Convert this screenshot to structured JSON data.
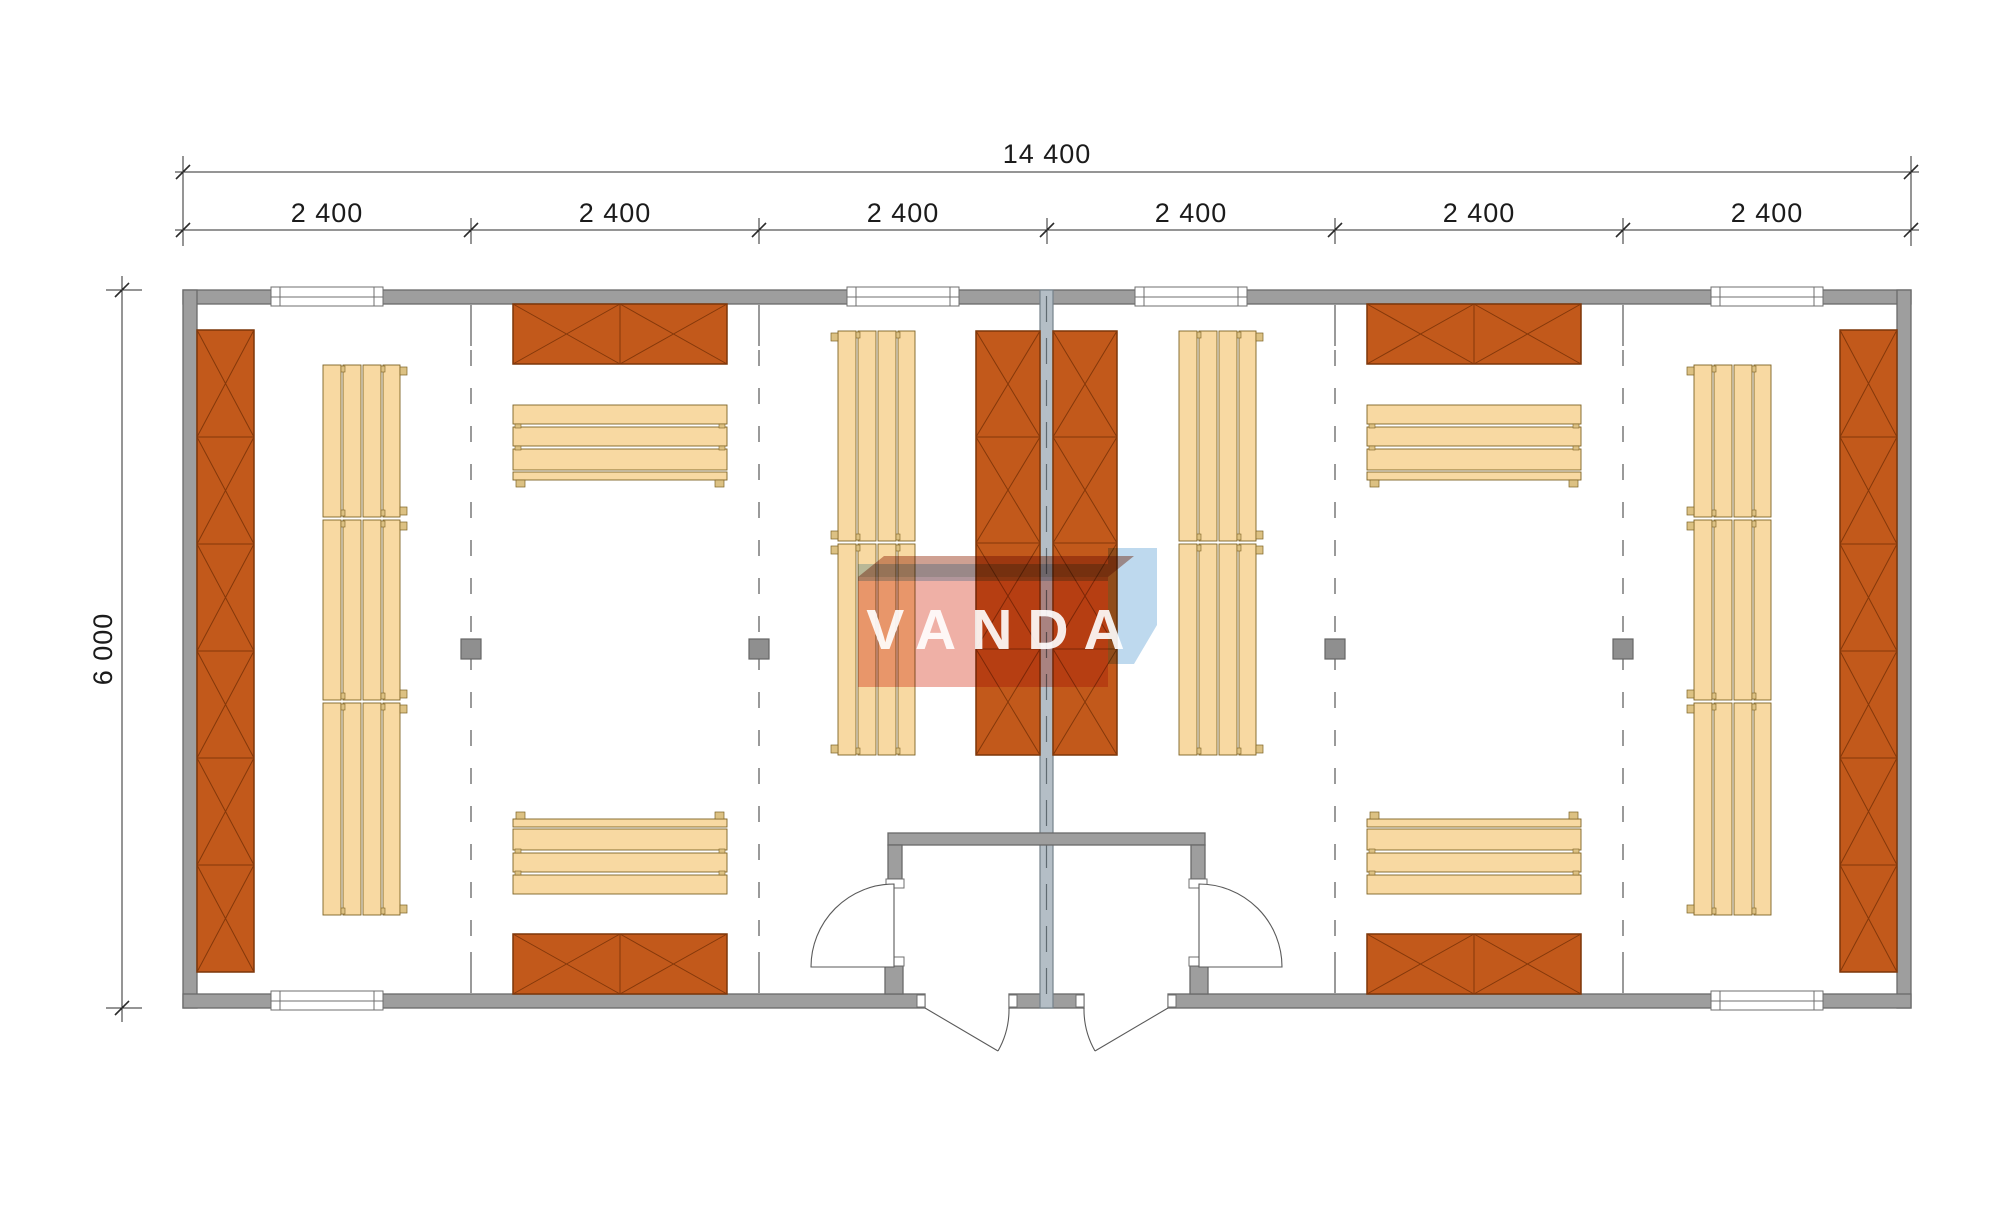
{
  "dimensions": {
    "overall_width": "14 400",
    "overall_depth": "6 000",
    "module_widths": [
      "2 400",
      "2 400",
      "2 400",
      "2 400",
      "2 400",
      "2 400"
    ]
  },
  "watermark": {
    "text": "VANDA"
  },
  "colors": {
    "wall_fill": "#9e9e9e",
    "wall_stroke": "#6a6a6a",
    "central_wall_fill": "#b4bec6",
    "central_wall_stroke": "#75818a",
    "cabinet_fill": "#c2591b",
    "cabinet_stroke": "#7c3609",
    "cabinet_line": "#84380a",
    "bench_fill": "#f8d9a2",
    "bench_stroke": "#7d6224",
    "bench_tab_fill": "#dcc183",
    "dashed_line": "#9a9a9a",
    "post_fill": "#8f8f8f",
    "dim_line": "#2b2b2b",
    "door_stroke": "#5a5a5a",
    "watermark_blue": "#bed9ee",
    "watermark_red": "#efb0a6",
    "watermark_red_dark": "#cfa092"
  }
}
